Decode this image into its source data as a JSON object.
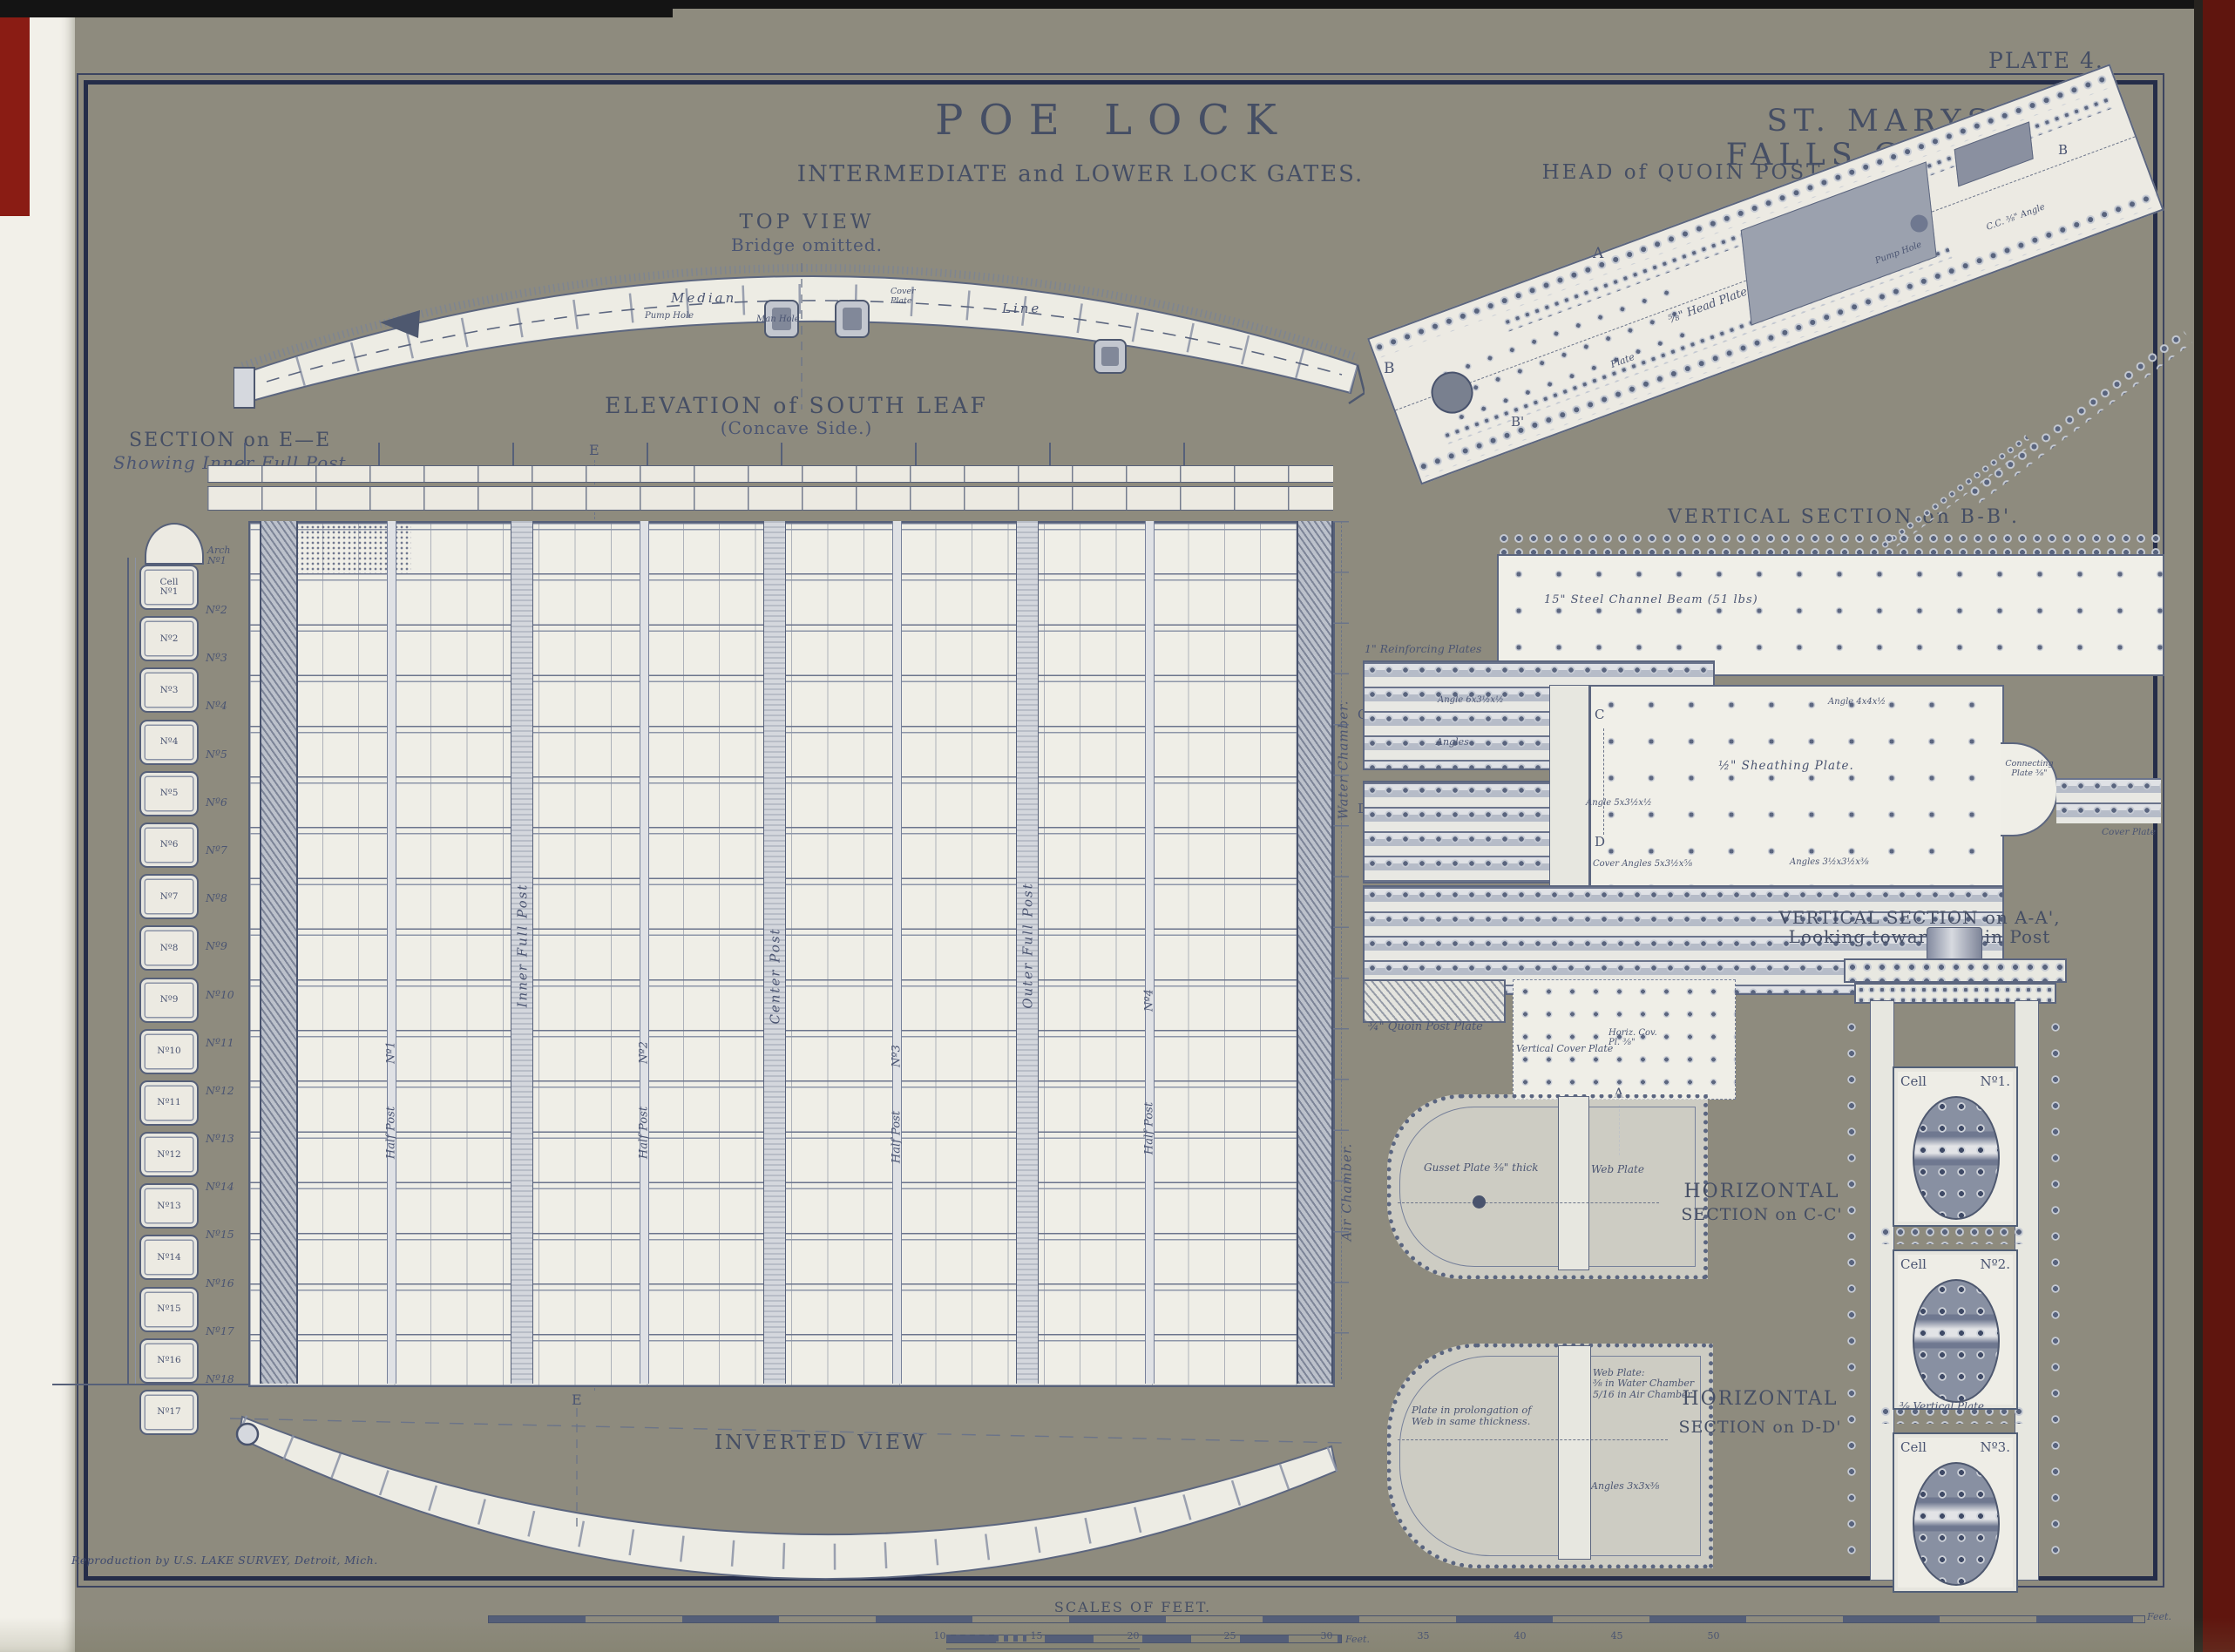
{
  "plate": {
    "number": "PLATE 4.",
    "title": "POE LOCK",
    "subtitle": "INTERMEDIATE and LOWER LOCK GATES.",
    "right_title": "ST. MARYS FALLS CANAL.",
    "credit": "Reproduction by U.S. LAKE SURVEY, Detroit, Mich."
  },
  "top_view": {
    "title": "TOP VIEW",
    "subtitle": "Bridge omitted.",
    "labels": {
      "median": "Median",
      "line": "Line",
      "pump_hole": "Pump Hole",
      "man_hole": "Man Hole",
      "cover_plate": "Cover\nPlate"
    }
  },
  "head_quoin": {
    "title": "HEAD of QUOIN POST.",
    "marker_a": "A",
    "marker_b": "B",
    "marker_b2": "B'",
    "marker_b3": "B",
    "labels": {
      "head_plate": "⅝\" Head Plate",
      "pump_hole": "Pump Hole",
      "plate": "Plate",
      "cc_angle": "C.C. ⅜\" Angle"
    }
  },
  "section_ee": {
    "title": "SECTION on E—E",
    "subtitle": "Showing Inner Full Post",
    "arch_top": "Arch\nNº1",
    "cells": [
      "Cell\nNº1",
      "Nº2",
      "Nº3",
      "Nº4",
      "Nº5",
      "Nº6",
      "Nº7",
      "Nº8",
      "Nº9",
      "Nº10",
      "Nº11",
      "Nº12",
      "Nº13",
      "Nº14",
      "Nº15",
      "Nº16",
      "Nº17"
    ],
    "arch_numbers": [
      "Nº2",
      "Nº3",
      "Nº4",
      "Nº5",
      "Nº6",
      "Nº7",
      "Nº8",
      "Nº9",
      "Nº10",
      "Nº11",
      "Nº12",
      "Nº13",
      "Nº14",
      "Nº15",
      "Nº16",
      "Nº17",
      "Nº18"
    ]
  },
  "elevation": {
    "title": "ELEVATION of SOUTH LEAF",
    "subtitle": "(Concave Side.)",
    "marker_e": "E",
    "posts": {
      "inner": "Inner Full Post",
      "center": "Center Post",
      "outer": "Outer Full Post",
      "half": "Half Post",
      "no1": "Nº1",
      "no2": "Nº2",
      "no3": "Nº3",
      "no4": "Nº4"
    },
    "water_chamber": "Water Chamber.",
    "air_chamber": "Air Chamber.",
    "marker_c": "C",
    "marker_d": "D"
  },
  "section_bb": {
    "title": "VERTICAL SECTION on B-B'.",
    "marker_c": "C",
    "marker_d": "D",
    "marker_a": "A",
    "labels": {
      "reinforcing": "1\" Reinforcing Plates",
      "channel_beam": "15\" Steel Channel Beam (51 lbs)",
      "angle_top": "Angle 4x4x½",
      "angle1": "Angle 6x3½x½",
      "angles": "Angles",
      "sheathing": "½\" Sheathing Plate.",
      "angle2": "Angle 5x3½x½",
      "cover_angles": "Cover Angles 5x3½x⅝",
      "angles2": "Angles 3½x3½x⅜",
      "connecting": "Connecting\nPlate ⅜\"",
      "cover_plate": "Cover Plate",
      "quoin_plate": "¾\" Quoin Post Plate",
      "vertical_cover": "Vertical Cover Plate",
      "horiz_cover": "Horiz. Cov.\nPl. ⅜\""
    }
  },
  "section_aa": {
    "title": "VERTICAL SECTION on A-A', Looking toward Quoin Post",
    "cells": [
      {
        "c": "Cell",
        "n": "Nº1."
      },
      {
        "c": "Cell",
        "n": "Nº2."
      },
      {
        "c": "Cell",
        "n": "Nº3."
      }
    ],
    "vertical_plate": "⅜ Vertical Plate"
  },
  "section_cc": {
    "title1": "HORIZONTAL",
    "title2": "SECTION on C-C'",
    "labels": {
      "gusset": "Gusset Plate ⅜\" thick",
      "web": "Web Plate"
    }
  },
  "section_dd": {
    "title1": "HORIZONTAL",
    "title2": "SECTION on D-D'",
    "labels": {
      "prolongation": "Plate in prolongation of\nWeb in same thickness.",
      "web": "Web Plate:\n⅜ in Water Chamber\n5/16 in Air Chamber.",
      "angles": "Angles 3x3x⅜"
    }
  },
  "inverted_view": {
    "title": "INVERTED VIEW"
  },
  "scales": {
    "title": "SCALES OF FEET.",
    "bar1_numbers": [
      "10",
      "15",
      "20",
      "25",
      "30",
      "35",
      "40",
      "45",
      "50"
    ],
    "feet": "Feet."
  }
}
